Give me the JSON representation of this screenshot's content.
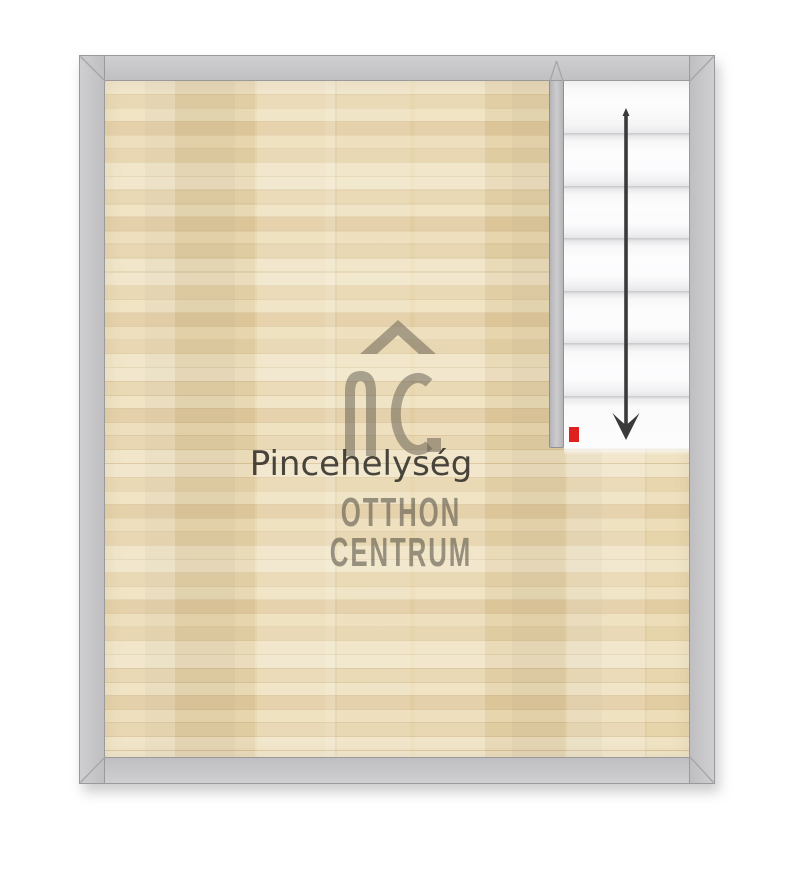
{
  "room": {
    "label": "Pincehelység"
  },
  "watermark": {
    "logo": "otthon-centrum-oc-roof-monogram",
    "brand_line1": "OTTHON",
    "brand_line2": "CENTRUM",
    "label_color": "#302d27",
    "brand_color": "#5f5a4d"
  },
  "floorplan": {
    "wall_color": "#c6c6c8",
    "floor_color": "#e9d7b2",
    "stairs": {
      "step_count": 7,
      "arrow_direction": "down",
      "arrow_color": "#3a3a3a",
      "marker_color": "#e01f1f",
      "tread_color": "#fbfbfc"
    }
  }
}
